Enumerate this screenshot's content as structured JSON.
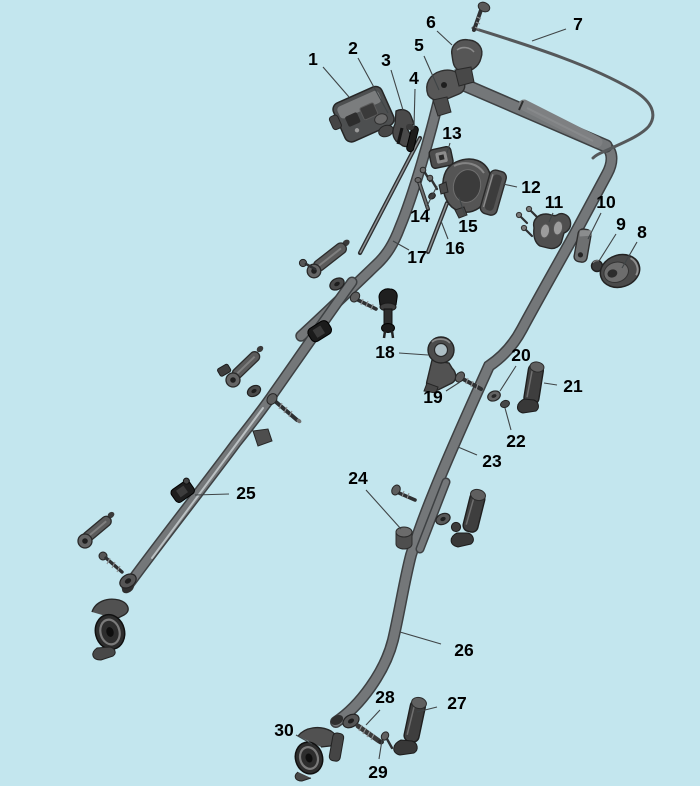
{
  "colors": {
    "background": "#c3e6ee",
    "label": "#000000",
    "leader": "#3f4446",
    "tube_outline": "#3e4143",
    "tube_fill": "#747779",
    "part_dark": "#3c3c3c",
    "part_mid": "#565656",
    "part_light": "#9c9c9c"
  },
  "callouts": [
    {
      "n": "1",
      "x": 313,
      "y": 59,
      "line": [
        323,
        67,
        349,
        97
      ]
    },
    {
      "n": "2",
      "x": 353,
      "y": 48,
      "line": [
        358,
        58,
        388,
        113
      ]
    },
    {
      "n": "3",
      "x": 386,
      "y": 60,
      "line": [
        391,
        70,
        403,
        110
      ]
    },
    {
      "n": "4",
      "x": 414,
      "y": 78,
      "line": [
        415,
        89,
        414,
        127
      ]
    },
    {
      "n": "5",
      "x": 419,
      "y": 45,
      "line": [
        424,
        56,
        439,
        90
      ]
    },
    {
      "n": "6",
      "x": 431,
      "y": 22,
      "line": [
        437,
        31,
        452,
        45
      ]
    },
    {
      "n": "7",
      "x": 578,
      "y": 24,
      "line": [
        566,
        29,
        532,
        41
      ]
    },
    {
      "n": "8",
      "x": 642,
      "y": 232,
      "line": [
        637,
        242,
        622,
        268
      ]
    },
    {
      "n": "9",
      "x": 621,
      "y": 224,
      "line": [
        616,
        234,
        599,
        261
      ]
    },
    {
      "n": "10",
      "x": 606,
      "y": 202,
      "line": [
        601,
        213,
        588,
        239
      ]
    },
    {
      "n": "11",
      "x": 554,
      "y": 202,
      "line": [
        553,
        213,
        549,
        222
      ]
    },
    {
      "n": "12",
      "x": 531,
      "y": 187,
      "line": [
        517,
        187,
        503,
        184
      ]
    },
    {
      "n": "13",
      "x": 452,
      "y": 133,
      "line": [
        450,
        143,
        447,
        153
      ]
    },
    {
      "n": "14",
      "x": 420,
      "y": 216,
      "line": [
        427,
        206,
        437,
        186
      ]
    },
    {
      "n": "15",
      "x": 468,
      "y": 226,
      "line": [
        465,
        216,
        459,
        197
      ]
    },
    {
      "n": "16",
      "x": 455,
      "y": 248,
      "line": [
        448,
        239,
        441,
        221
      ]
    },
    {
      "n": "17",
      "x": 417,
      "y": 257,
      "line": [
        409,
        250,
        393,
        241
      ]
    },
    {
      "n": "18",
      "x": 385,
      "y": 352,
      "line": [
        399,
        353,
        428,
        355
      ]
    },
    {
      "n": "19",
      "x": 433,
      "y": 397,
      "line": [
        446,
        391,
        460,
        382
      ]
    },
    {
      "n": "20",
      "x": 521,
      "y": 355,
      "line": [
        516,
        366,
        500,
        391
      ]
    },
    {
      "n": "21",
      "x": 573,
      "y": 386,
      "line": [
        557,
        385,
        544,
        383
      ]
    },
    {
      "n": "22",
      "x": 516,
      "y": 441,
      "line": [
        511,
        430,
        505,
        408
      ]
    },
    {
      "n": "23",
      "x": 492,
      "y": 461,
      "line": [
        477,
        455,
        458,
        447
      ]
    },
    {
      "n": "24",
      "x": 358,
      "y": 478,
      "line": [
        366,
        490,
        401,
        529
      ]
    },
    {
      "n": "25",
      "x": 246,
      "y": 493,
      "line": [
        229,
        494,
        195,
        495
      ]
    },
    {
      "n": "26",
      "x": 464,
      "y": 650,
      "line": [
        441,
        644,
        400,
        632
      ]
    },
    {
      "n": "27",
      "x": 457,
      "y": 703,
      "line": [
        437,
        707,
        417,
        712
      ]
    },
    {
      "n": "28",
      "x": 385,
      "y": 697,
      "line": [
        380,
        710,
        366,
        725
      ]
    },
    {
      "n": "29",
      "x": 378,
      "y": 772,
      "line": [
        379,
        759,
        382,
        740
      ]
    },
    {
      "n": "30",
      "x": 284,
      "y": 730,
      "line": [
        296,
        735,
        312,
        744
      ]
    }
  ]
}
